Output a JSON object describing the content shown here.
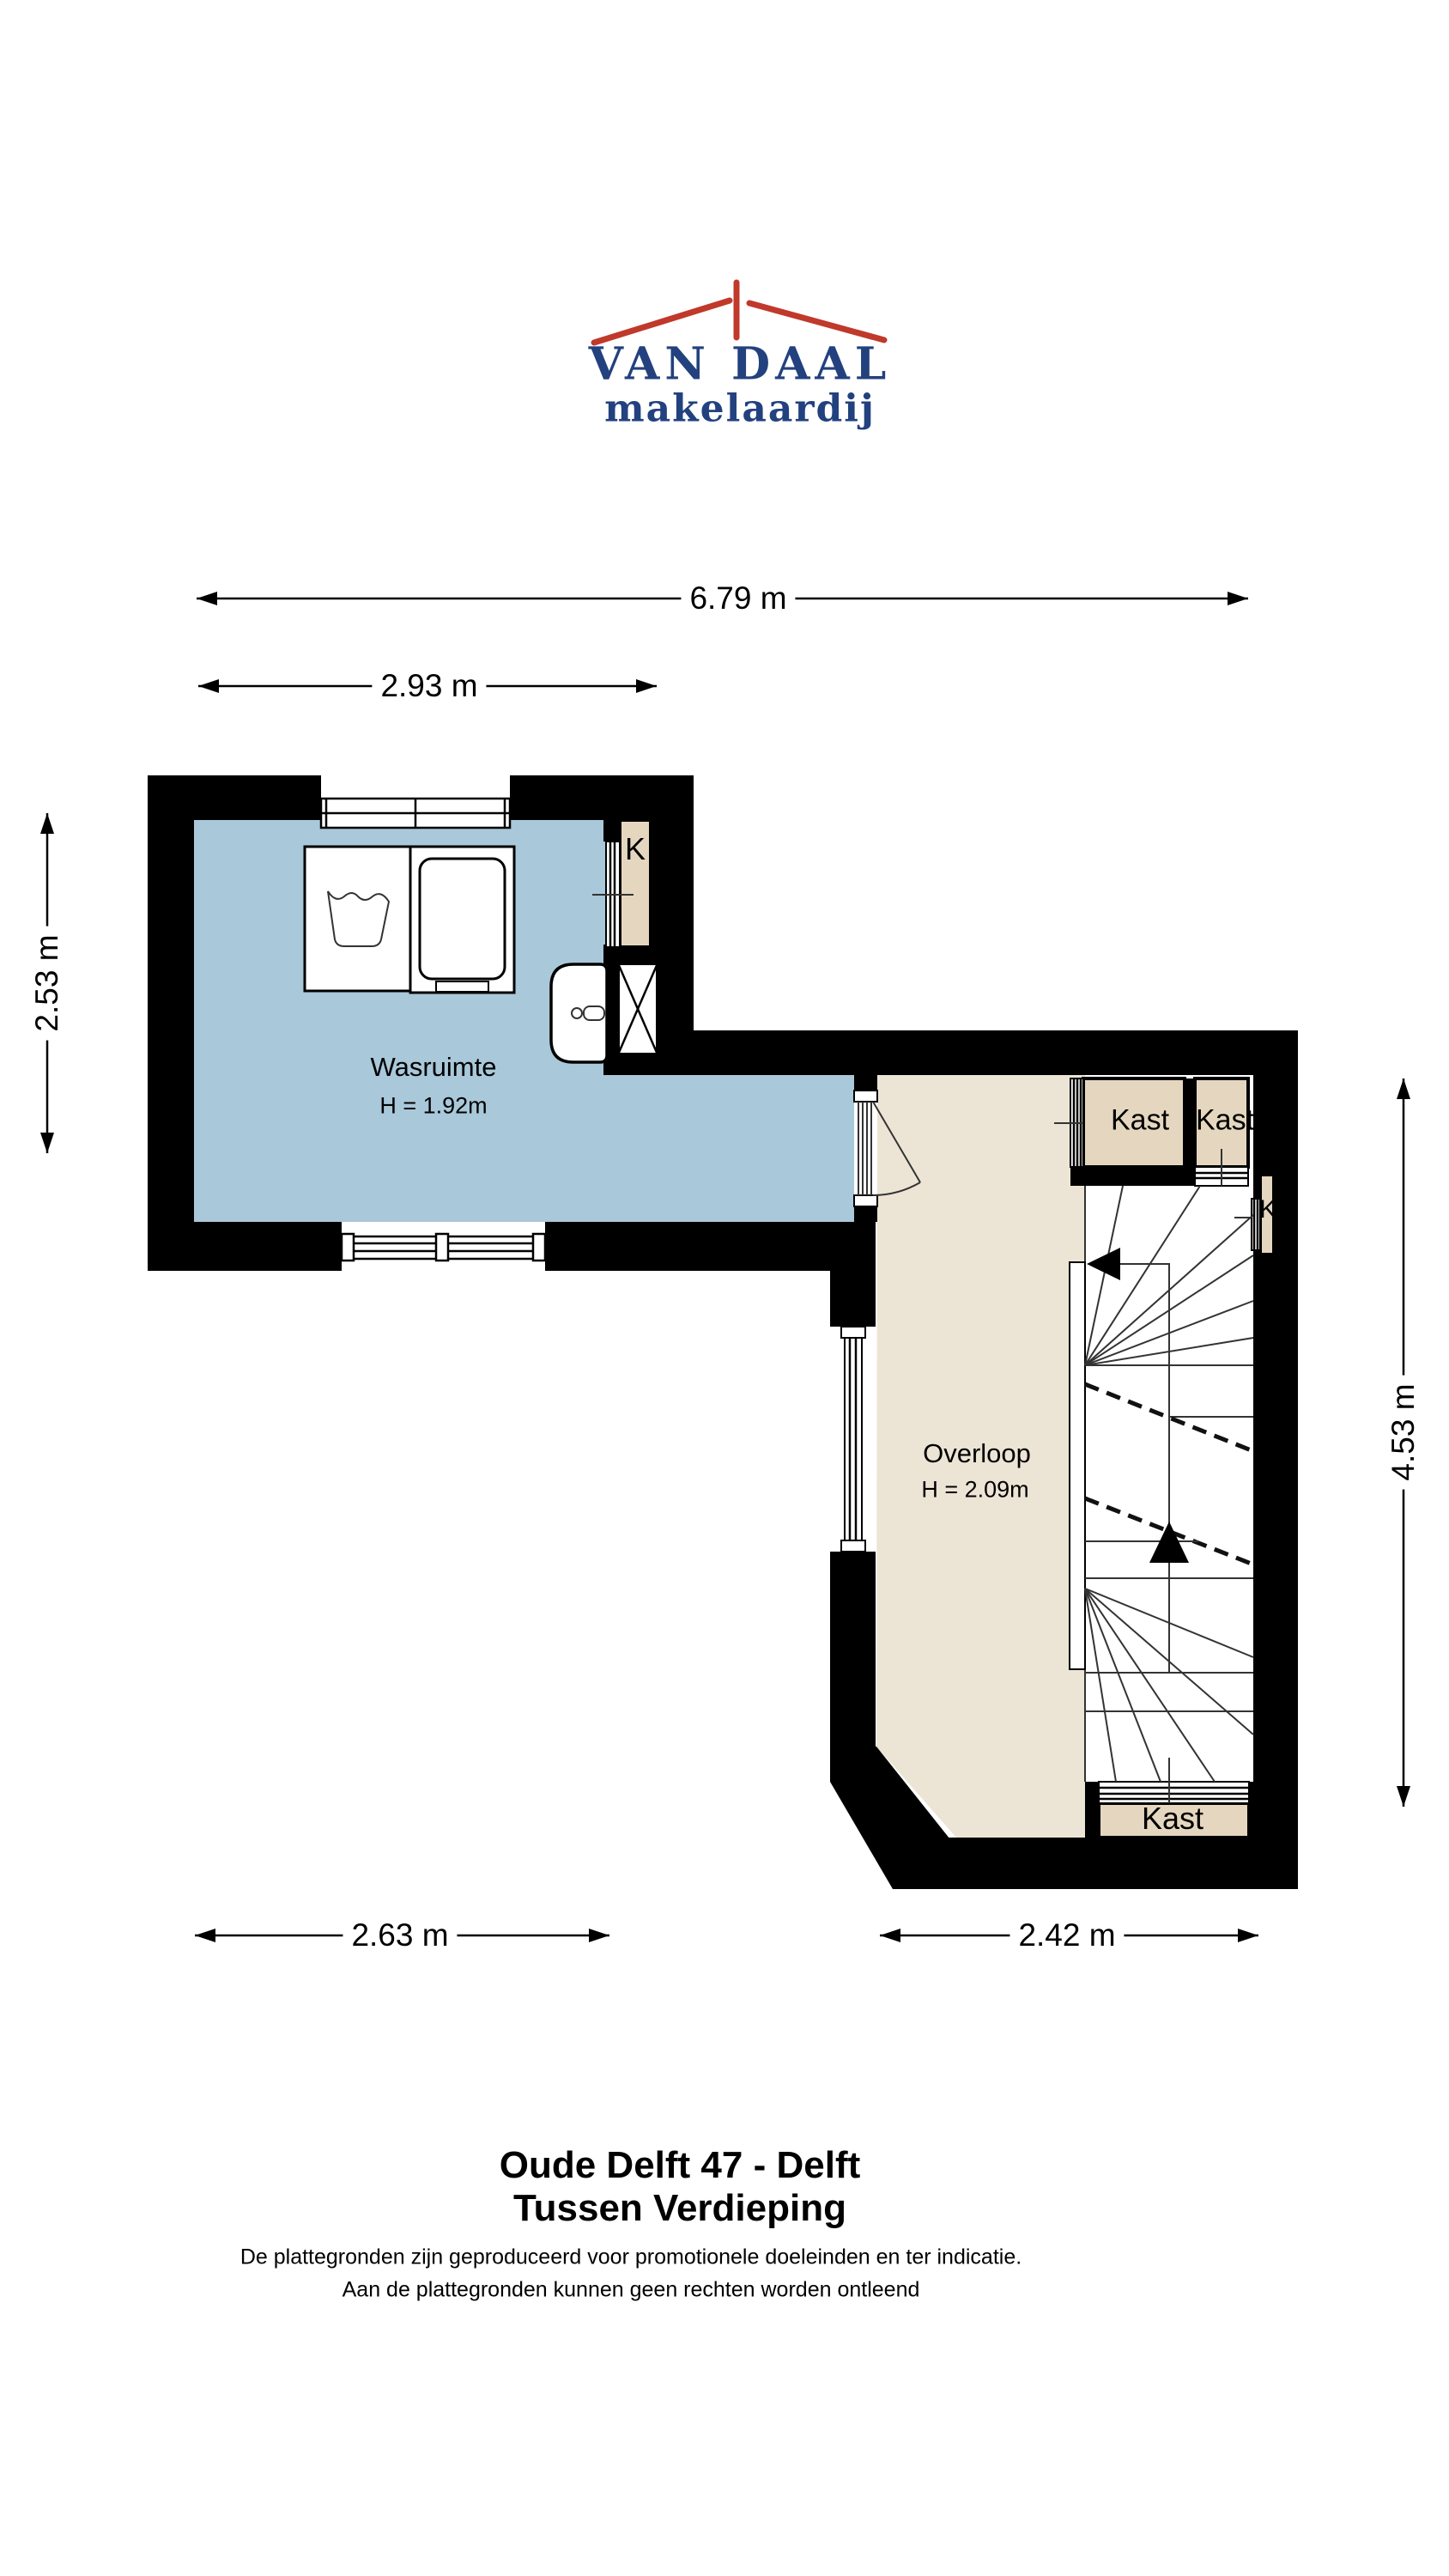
{
  "logo": {
    "title": "VAN DAAL",
    "subtitle": "makelaardij",
    "icon": "roof-icon"
  },
  "colors": {
    "wall": "#000000",
    "laundry_floor": "#a9c8d9",
    "landing_floor": "#ece4d5",
    "closet_fill": "#e5d7bf",
    "logo_blue": "#22417e",
    "logo_red": "#c0392b",
    "line": "#333333"
  },
  "dimensions": {
    "top_total": "6.79 m",
    "top_left_section": "2.93 m",
    "left_side": "2.53 m",
    "right_side": "4.53 m",
    "bottom_left": "2.63 m",
    "bottom_right": "2.42 m"
  },
  "rooms": {
    "laundry": {
      "name": "Wasruimte",
      "height": "H = 1.92m"
    },
    "landing": {
      "name": "Overloop",
      "height": "H = 2.09m"
    }
  },
  "closets": {
    "k_top": "K",
    "kast_top_1": "Kast",
    "kast_top_2": "Kast",
    "k_right": "K",
    "kast_bottom": "Kast"
  },
  "footer": {
    "address": "Oude Delft 47 - Delft",
    "floor": "Tussen Verdieping",
    "disclaimer_1": "De plattegronden zijn geproduceerd voor promotionele doeleinden en ter indicatie.",
    "disclaimer_2": "Aan de plattegronden kunnen geen rechten worden ontleend"
  }
}
